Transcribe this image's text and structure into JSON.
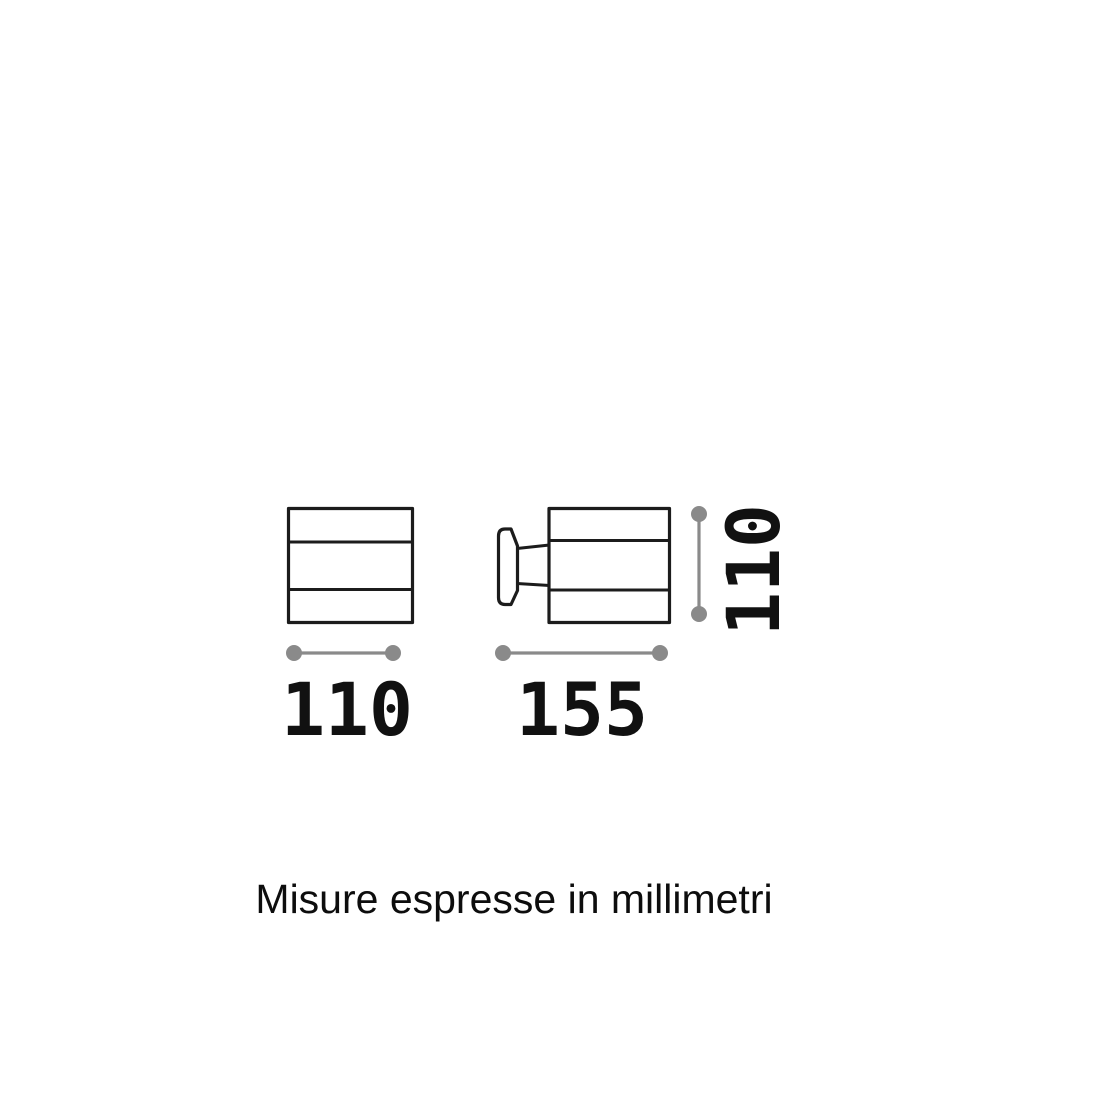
{
  "diagram": {
    "caption": "Misure espresse in millimetri",
    "dimensions": {
      "front_width": "110",
      "side_depth": "155",
      "side_height": "110"
    },
    "colors": {
      "background": "#ffffff",
      "outline": "#1c1c1c",
      "dimension_line": "#8a8a8a",
      "label_text": "#111111"
    }
  }
}
